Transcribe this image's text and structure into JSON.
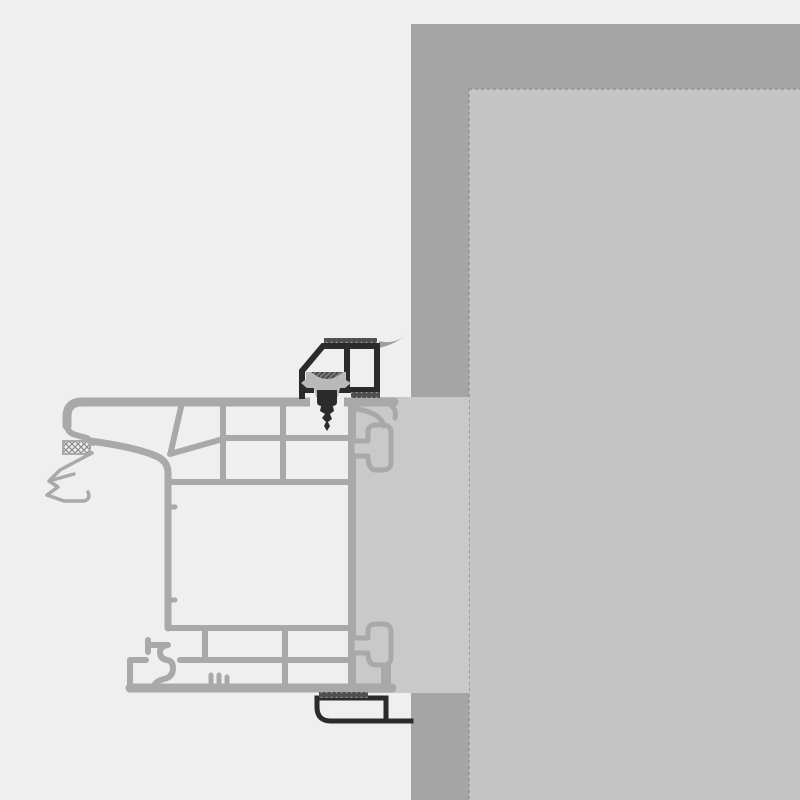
{
  "diagram": {
    "title": "Window frame installation cross-section",
    "parts": {
      "wall_section": "wall section (cut)",
      "window_reveal": "window reveal surface",
      "plaster_patch": "plaster strip behind frame",
      "frame_profile": "multi-chamber window frame profile",
      "outer_gasket": "outer gasket seal",
      "mounting_bracket": "mounting bracket profile",
      "fixing_clip": "fixing clip plug",
      "fixing_screw": "fixing screw",
      "sealant_bead": "sealant bead",
      "anchor_lug_top": "top anchor lug",
      "anchor_lug_bottom": "bottom anchor lug",
      "adhesive_tape": "adhesive foam tape",
      "finishing_trim": "interior finishing trim"
    }
  },
  "colors": {
    "background": "#efefef",
    "wall": "#a5a5a5",
    "reveal": "#c5c5c5",
    "reveal_border": "#9a9a9a",
    "patch": "#c9c9c9",
    "frame": "#a9a9a9",
    "dark": "#2b2b2b",
    "clip": "#b9b9b9",
    "sealant": "#9e9e9e",
    "hatch_line": "#8d8d8d",
    "tape_base": "#4f4f4f",
    "tape_dot": "#9b9b9b",
    "recess_base": "#757575",
    "recess_line": "#3a3a3a"
  }
}
